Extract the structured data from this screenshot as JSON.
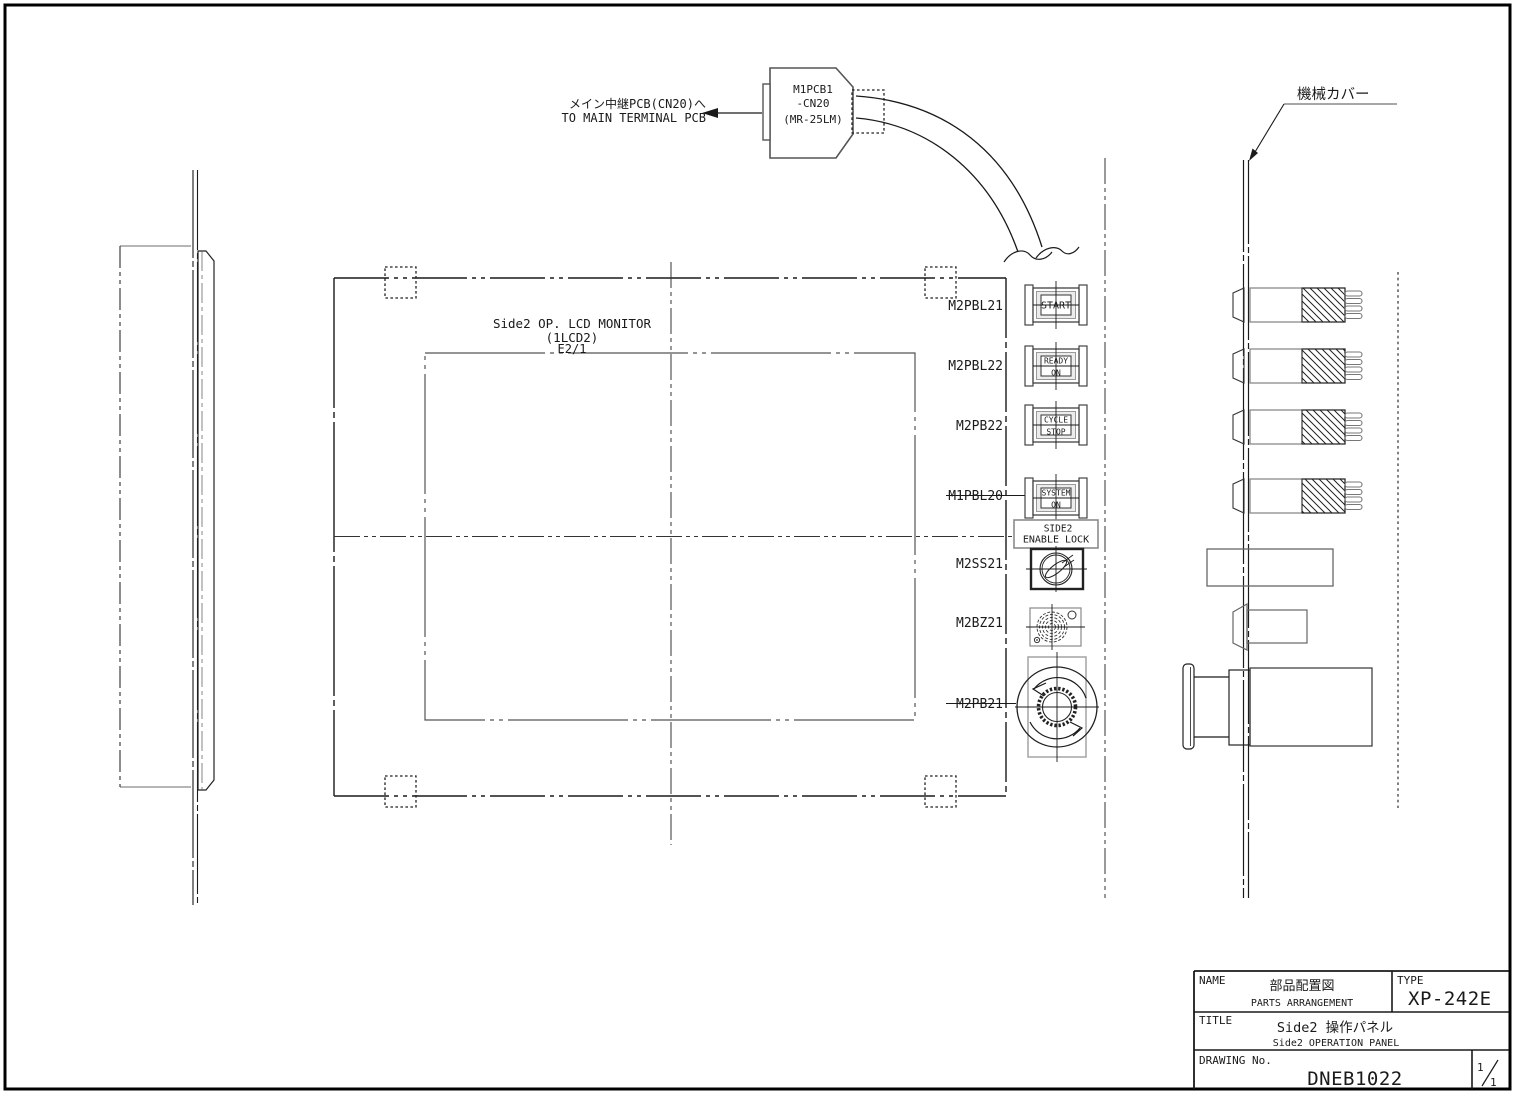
{
  "connector": {
    "line1": "M1PCB1",
    "line2": "-CN20",
    "line3": "(MR-25LM)",
    "note_jp": "メイン中継PCB(CN20)へ",
    "note_en": "TO MAIN TERMINAL PCB"
  },
  "machine_cover": {
    "label": "機械カバー"
  },
  "lcd_monitor": {
    "line1": "Side2 OP. LCD MONITOR",
    "line2": "(1LCD2)",
    "line3": "E2/1"
  },
  "components": {
    "start": {
      "ref": "M2PBL21",
      "lens1": "START"
    },
    "ready": {
      "ref": "M2PBL22",
      "lens1": "READY",
      "lens2": "ON"
    },
    "cycle": {
      "ref": "M2PB22",
      "lens1": "CYCLE",
      "lens2": "STOP"
    },
    "system": {
      "ref": "M1PBL20",
      "lens1": "SYSTEM",
      "lens2": "ON"
    },
    "plate": {
      "line1": "SIDE2",
      "line2": "ENABLE LOCK"
    },
    "keyswitch": {
      "ref": "M2SS21"
    },
    "buzzer": {
      "ref": "M2BZ21"
    },
    "estop": {
      "ref": "M2PB21"
    }
  },
  "title_block": {
    "name_label": "NAME",
    "name_jp": "部品配置図",
    "name_en": "PARTS ARRANGEMENT",
    "type_label": "TYPE",
    "type_value": "XP-242E",
    "title_label": "TITLE",
    "title_jp": "Side2 操作パネル",
    "title_en": "Side2 OPERATION PANEL",
    "drawing_label": "DRAWING No.",
    "drawing_no": "DNEB1022",
    "sheet_num": "1",
    "sheet_total": "1"
  },
  "colors": {
    "line": "#1a1a1a",
    "secondary": "#8a8a8a",
    "background": "#ffffff"
  }
}
